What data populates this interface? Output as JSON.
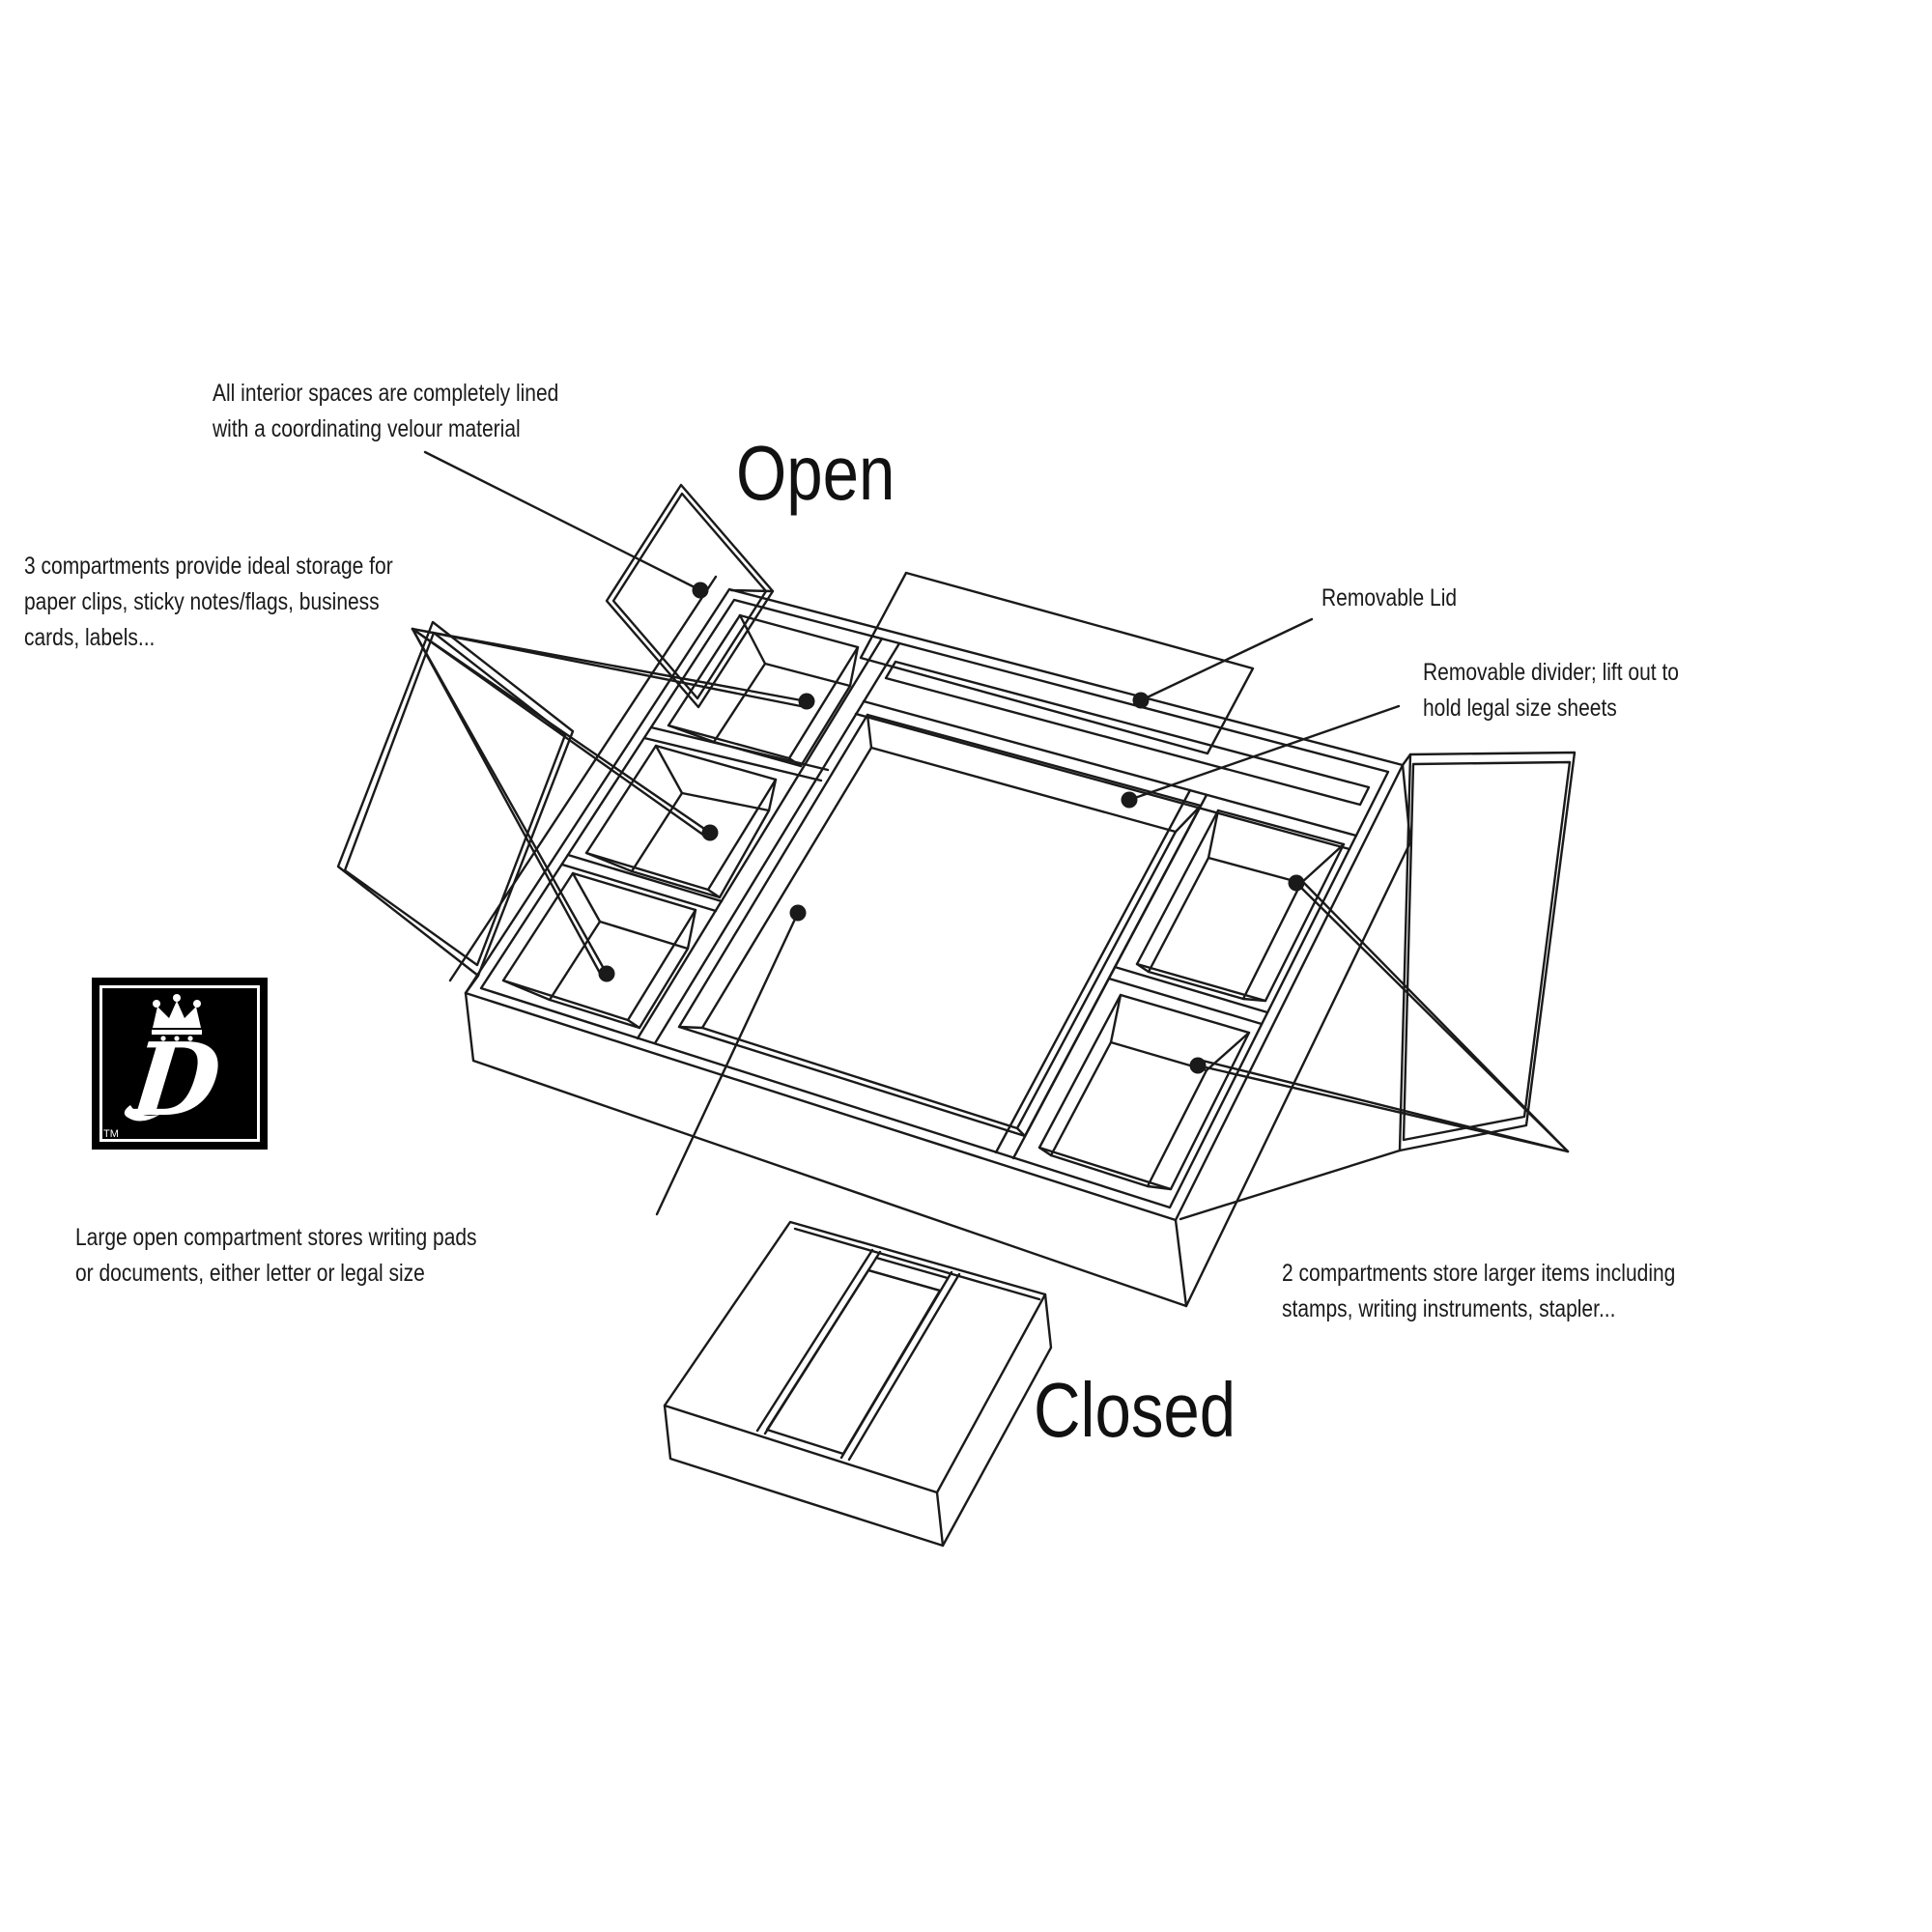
{
  "labels": {
    "open": "Open",
    "closed": "Closed"
  },
  "annotations": {
    "velour": {
      "lines": [
        "All interior spaces are completely lined",
        "with a coordinating velour material"
      ]
    },
    "three_compartments": {
      "lines": [
        "3 compartments provide ideal storage for",
        "paper clips, sticky notes/flags, business",
        "cards, labels..."
      ]
    },
    "removable_lid": {
      "lines": [
        "Removable Lid"
      ]
    },
    "removable_divider": {
      "lines": [
        "Removable divider; lift out to",
        "hold legal size sheets"
      ]
    },
    "large_compartment": {
      "lines": [
        "Large open compartment stores writing pads",
        "or documents, either letter or legal size"
      ]
    },
    "two_compartments": {
      "lines": [
        "2 compartments store larger items including",
        "stamps, writing instruments, stapler..."
      ]
    }
  },
  "logo": {
    "letter": "D",
    "trademark": "TM"
  },
  "colors": {
    "ink": "#1a1a1a",
    "background": "#ffffff",
    "logo_bg": "#000000",
    "logo_fg": "#ffffff"
  }
}
